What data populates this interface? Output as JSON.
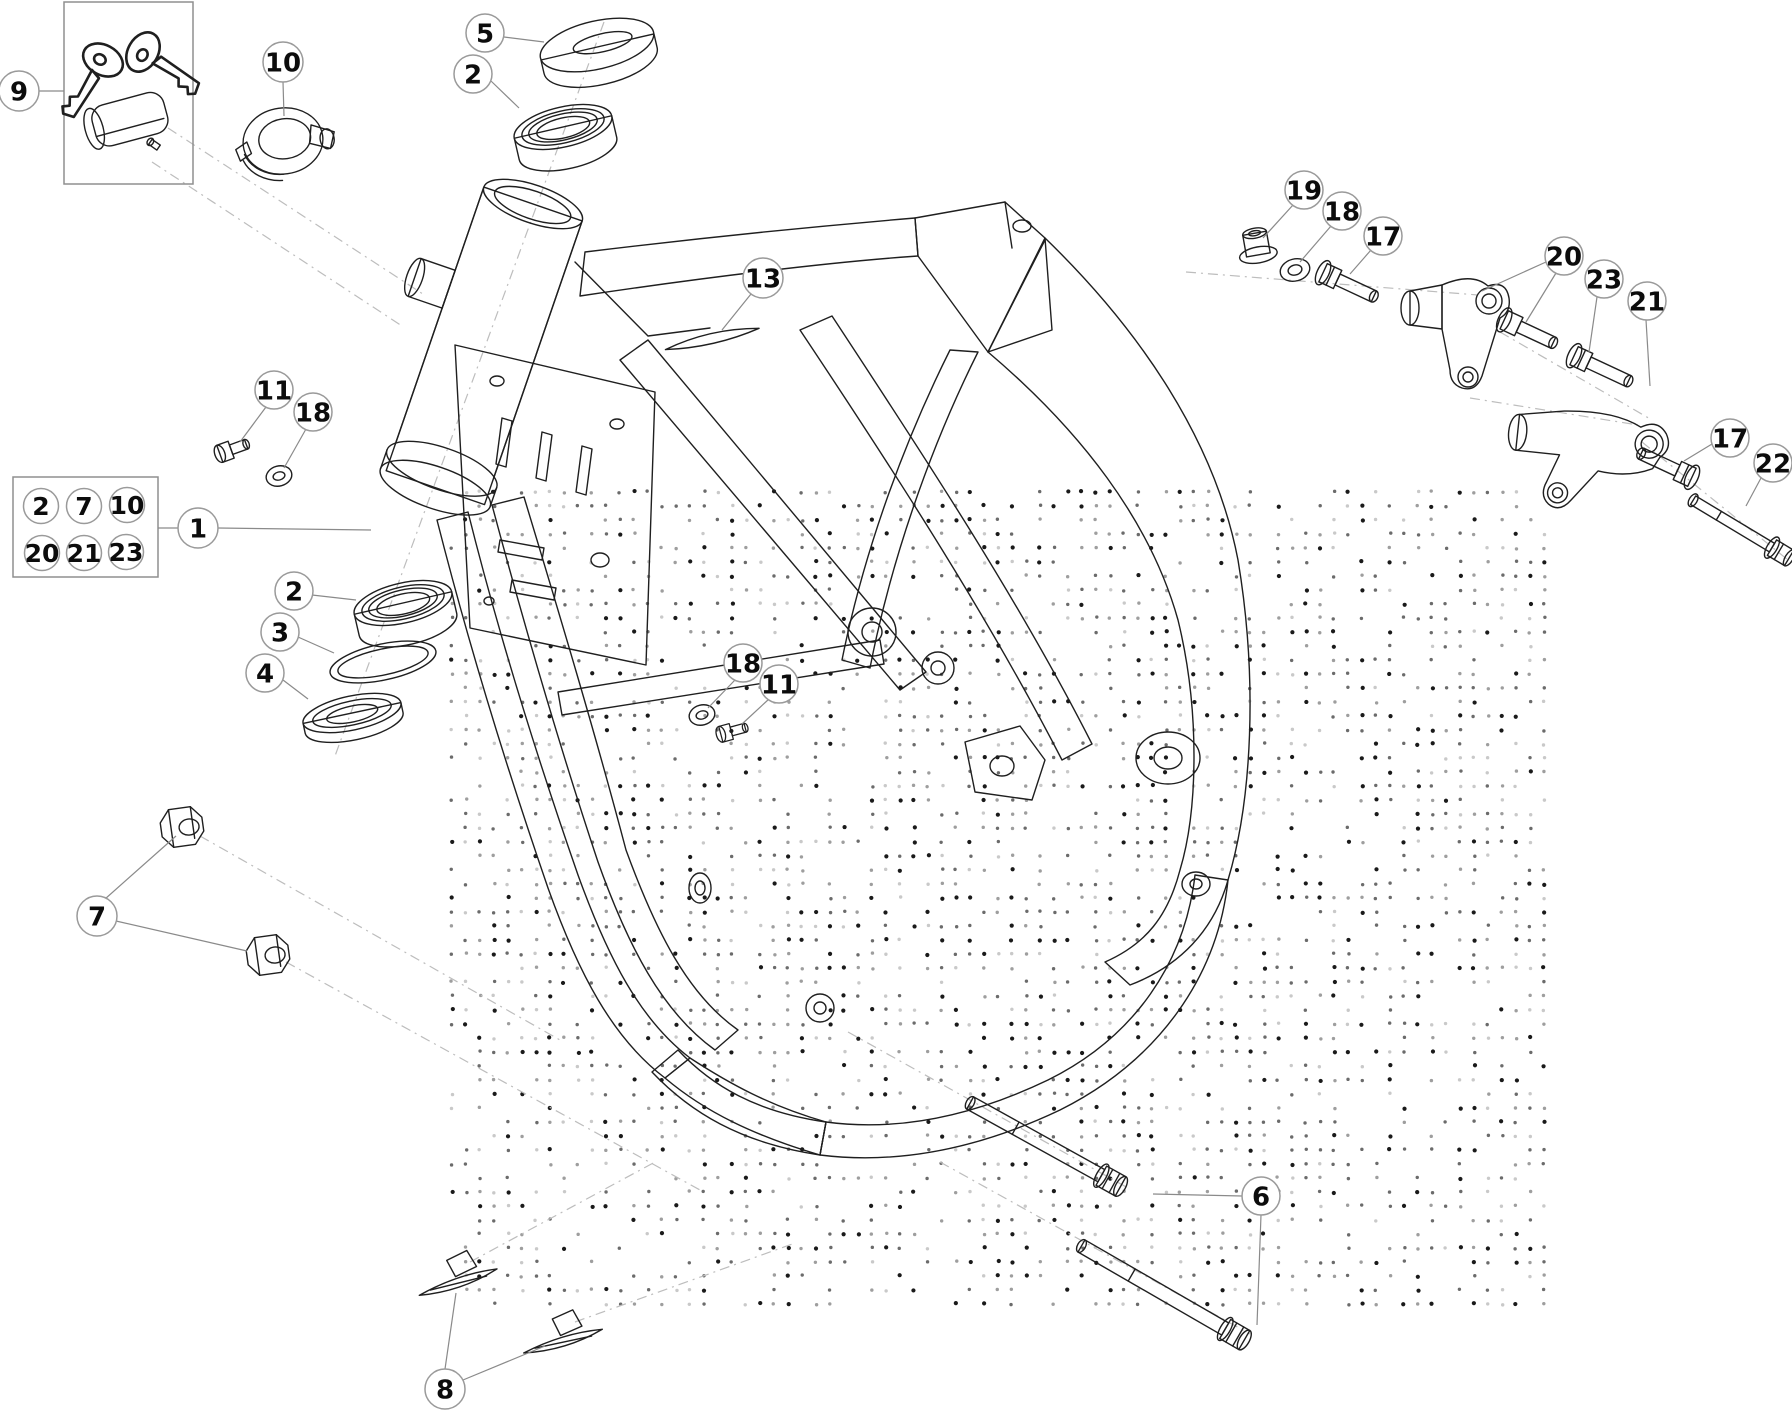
{
  "diagram": {
    "colors": {
      "background": "#ffffff",
      "line": "#1f1f1f",
      "leader": "#8a8a8a",
      "callout_stroke": "#9a9a9a",
      "dash_axis": "#bdbdbd",
      "dot_dark": "#1a1a1a",
      "dot_mid": "#6b6b6b",
      "dot_light": "#9e9e9e",
      "dot_faint": "#c9c9c9"
    },
    "watermark": {
      "x0": 452,
      "y0": 492,
      "x1": 1552,
      "y1": 1308,
      "pitch": 14,
      "bands": [
        [
          560,
          720
        ],
        [
          800,
          980
        ],
        [
          1040,
          1240
        ],
        [
          1300,
          1470
        ]
      ]
    },
    "key_box": {
      "x": 64,
      "y": 2,
      "w": 129,
      "h": 182
    },
    "group_box": {
      "x": 13,
      "y": 477,
      "w": 145,
      "h": 100,
      "items": [
        {
          "label": "2",
          "x": 41,
          "y": 506
        },
        {
          "label": "7",
          "x": 84,
          "y": 506
        },
        {
          "label": "10",
          "x": 127,
          "y": 505
        },
        {
          "label": "20",
          "x": 42,
          "y": 553
        },
        {
          "label": "21",
          "x": 84,
          "y": 553
        },
        {
          "label": "23",
          "x": 126,
          "y": 552
        }
      ]
    },
    "callouts": [
      {
        "id": "9",
        "label": "9",
        "x": 19,
        "y": 91,
        "r": 20,
        "leaders": [
          [
            39,
            91,
            64,
            91
          ]
        ]
      },
      {
        "id": "10",
        "label": "10",
        "x": 283,
        "y": 62,
        "r": 20,
        "leaders": [
          [
            283,
            82,
            284,
            116
          ]
        ]
      },
      {
        "id": "5",
        "label": "5",
        "x": 485,
        "y": 33,
        "r": 19,
        "leaders": [
          [
            504,
            37,
            544,
            42
          ]
        ]
      },
      {
        "id": "2-top",
        "label": "2",
        "x": 473,
        "y": 74,
        "r": 19,
        "leaders": [
          [
            491,
            81,
            519,
            108
          ]
        ]
      },
      {
        "id": "13",
        "label": "13",
        "x": 763,
        "y": 278,
        "r": 20,
        "leaders": [
          [
            751,
            294,
            722,
            330
          ]
        ]
      },
      {
        "id": "19",
        "label": "19",
        "x": 1304,
        "y": 190,
        "r": 19,
        "leaders": [
          [
            1293,
            205,
            1263,
            238
          ]
        ]
      },
      {
        "id": "18-right",
        "label": "18",
        "x": 1342,
        "y": 211,
        "r": 19,
        "leaders": [
          [
            1331,
            226,
            1300,
            262
          ]
        ]
      },
      {
        "id": "17-upper",
        "label": "17",
        "x": 1383,
        "y": 236,
        "r": 19,
        "leaders": [
          [
            1371,
            250,
            1350,
            274
          ]
        ]
      },
      {
        "id": "20",
        "label": "20",
        "x": 1564,
        "y": 256,
        "r": 19,
        "leaders": [
          [
            1546,
            262,
            1482,
            291
          ],
          [
            1556,
            273,
            1526,
            322
          ]
        ]
      },
      {
        "id": "23",
        "label": "23",
        "x": 1604,
        "y": 279,
        "r": 19,
        "leaders": [
          [
            1597,
            297,
            1589,
            352
          ]
        ]
      },
      {
        "id": "21",
        "label": "21",
        "x": 1647,
        "y": 301,
        "r": 19,
        "leaders": [
          [
            1646,
            320,
            1650,
            386
          ]
        ]
      },
      {
        "id": "17-lower",
        "label": "17",
        "x": 1730,
        "y": 438,
        "r": 19,
        "leaders": [
          [
            1712,
            444,
            1684,
            461
          ]
        ]
      },
      {
        "id": "22",
        "label": "22",
        "x": 1773,
        "y": 463,
        "r": 19,
        "leaders": [
          [
            1761,
            478,
            1746,
            506
          ]
        ]
      },
      {
        "id": "11-left",
        "label": "11",
        "x": 274,
        "y": 390,
        "r": 19,
        "leaders": [
          [
            266,
            407,
            240,
            442
          ]
        ]
      },
      {
        "id": "18-left",
        "label": "18",
        "x": 313,
        "y": 412,
        "r": 19,
        "leaders": [
          [
            306,
            429,
            284,
            468
          ]
        ]
      },
      {
        "id": "1",
        "label": "1",
        "x": 198,
        "y": 528,
        "r": 20,
        "leaders": [
          [
            158,
            528,
            178,
            528
          ],
          [
            218,
            528,
            371,
            530
          ]
        ]
      },
      {
        "id": "2-left",
        "label": "2",
        "x": 294,
        "y": 591,
        "r": 19,
        "leaders": [
          [
            312,
            595,
            356,
            600
          ]
        ]
      },
      {
        "id": "3",
        "label": "3",
        "x": 280,
        "y": 632,
        "r": 19,
        "leaders": [
          [
            298,
            637,
            334,
            653
          ]
        ]
      },
      {
        "id": "4",
        "label": "4",
        "x": 265,
        "y": 673,
        "r": 19,
        "leaders": [
          [
            283,
            680,
            308,
            699
          ]
        ]
      },
      {
        "id": "7",
        "label": "7",
        "x": 97,
        "y": 916,
        "r": 20,
        "leaders": [
          [
            105,
            899,
            176,
            836
          ],
          [
            116,
            921,
            247,
            951
          ]
        ]
      },
      {
        "id": "8",
        "label": "8",
        "x": 445,
        "y": 1389,
        "r": 20,
        "leaders": [
          [
            445,
            1369,
            456,
            1293
          ],
          [
            463,
            1380,
            545,
            1346
          ]
        ]
      },
      {
        "id": "6",
        "label": "6",
        "x": 1261,
        "y": 1196,
        "r": 19,
        "leaders": [
          [
            1242,
            1196,
            1153,
            1194
          ],
          [
            1261,
            1215,
            1257,
            1325
          ]
        ]
      },
      {
        "id": "18-mid",
        "label": "18",
        "x": 743,
        "y": 663,
        "r": 19,
        "leaders": [
          [
            735,
            680,
            708,
            708
          ]
        ]
      },
      {
        "id": "11-mid",
        "label": "11",
        "x": 779,
        "y": 684,
        "r": 19,
        "leaders": [
          [
            769,
            699,
            742,
            724
          ]
        ]
      }
    ]
  }
}
